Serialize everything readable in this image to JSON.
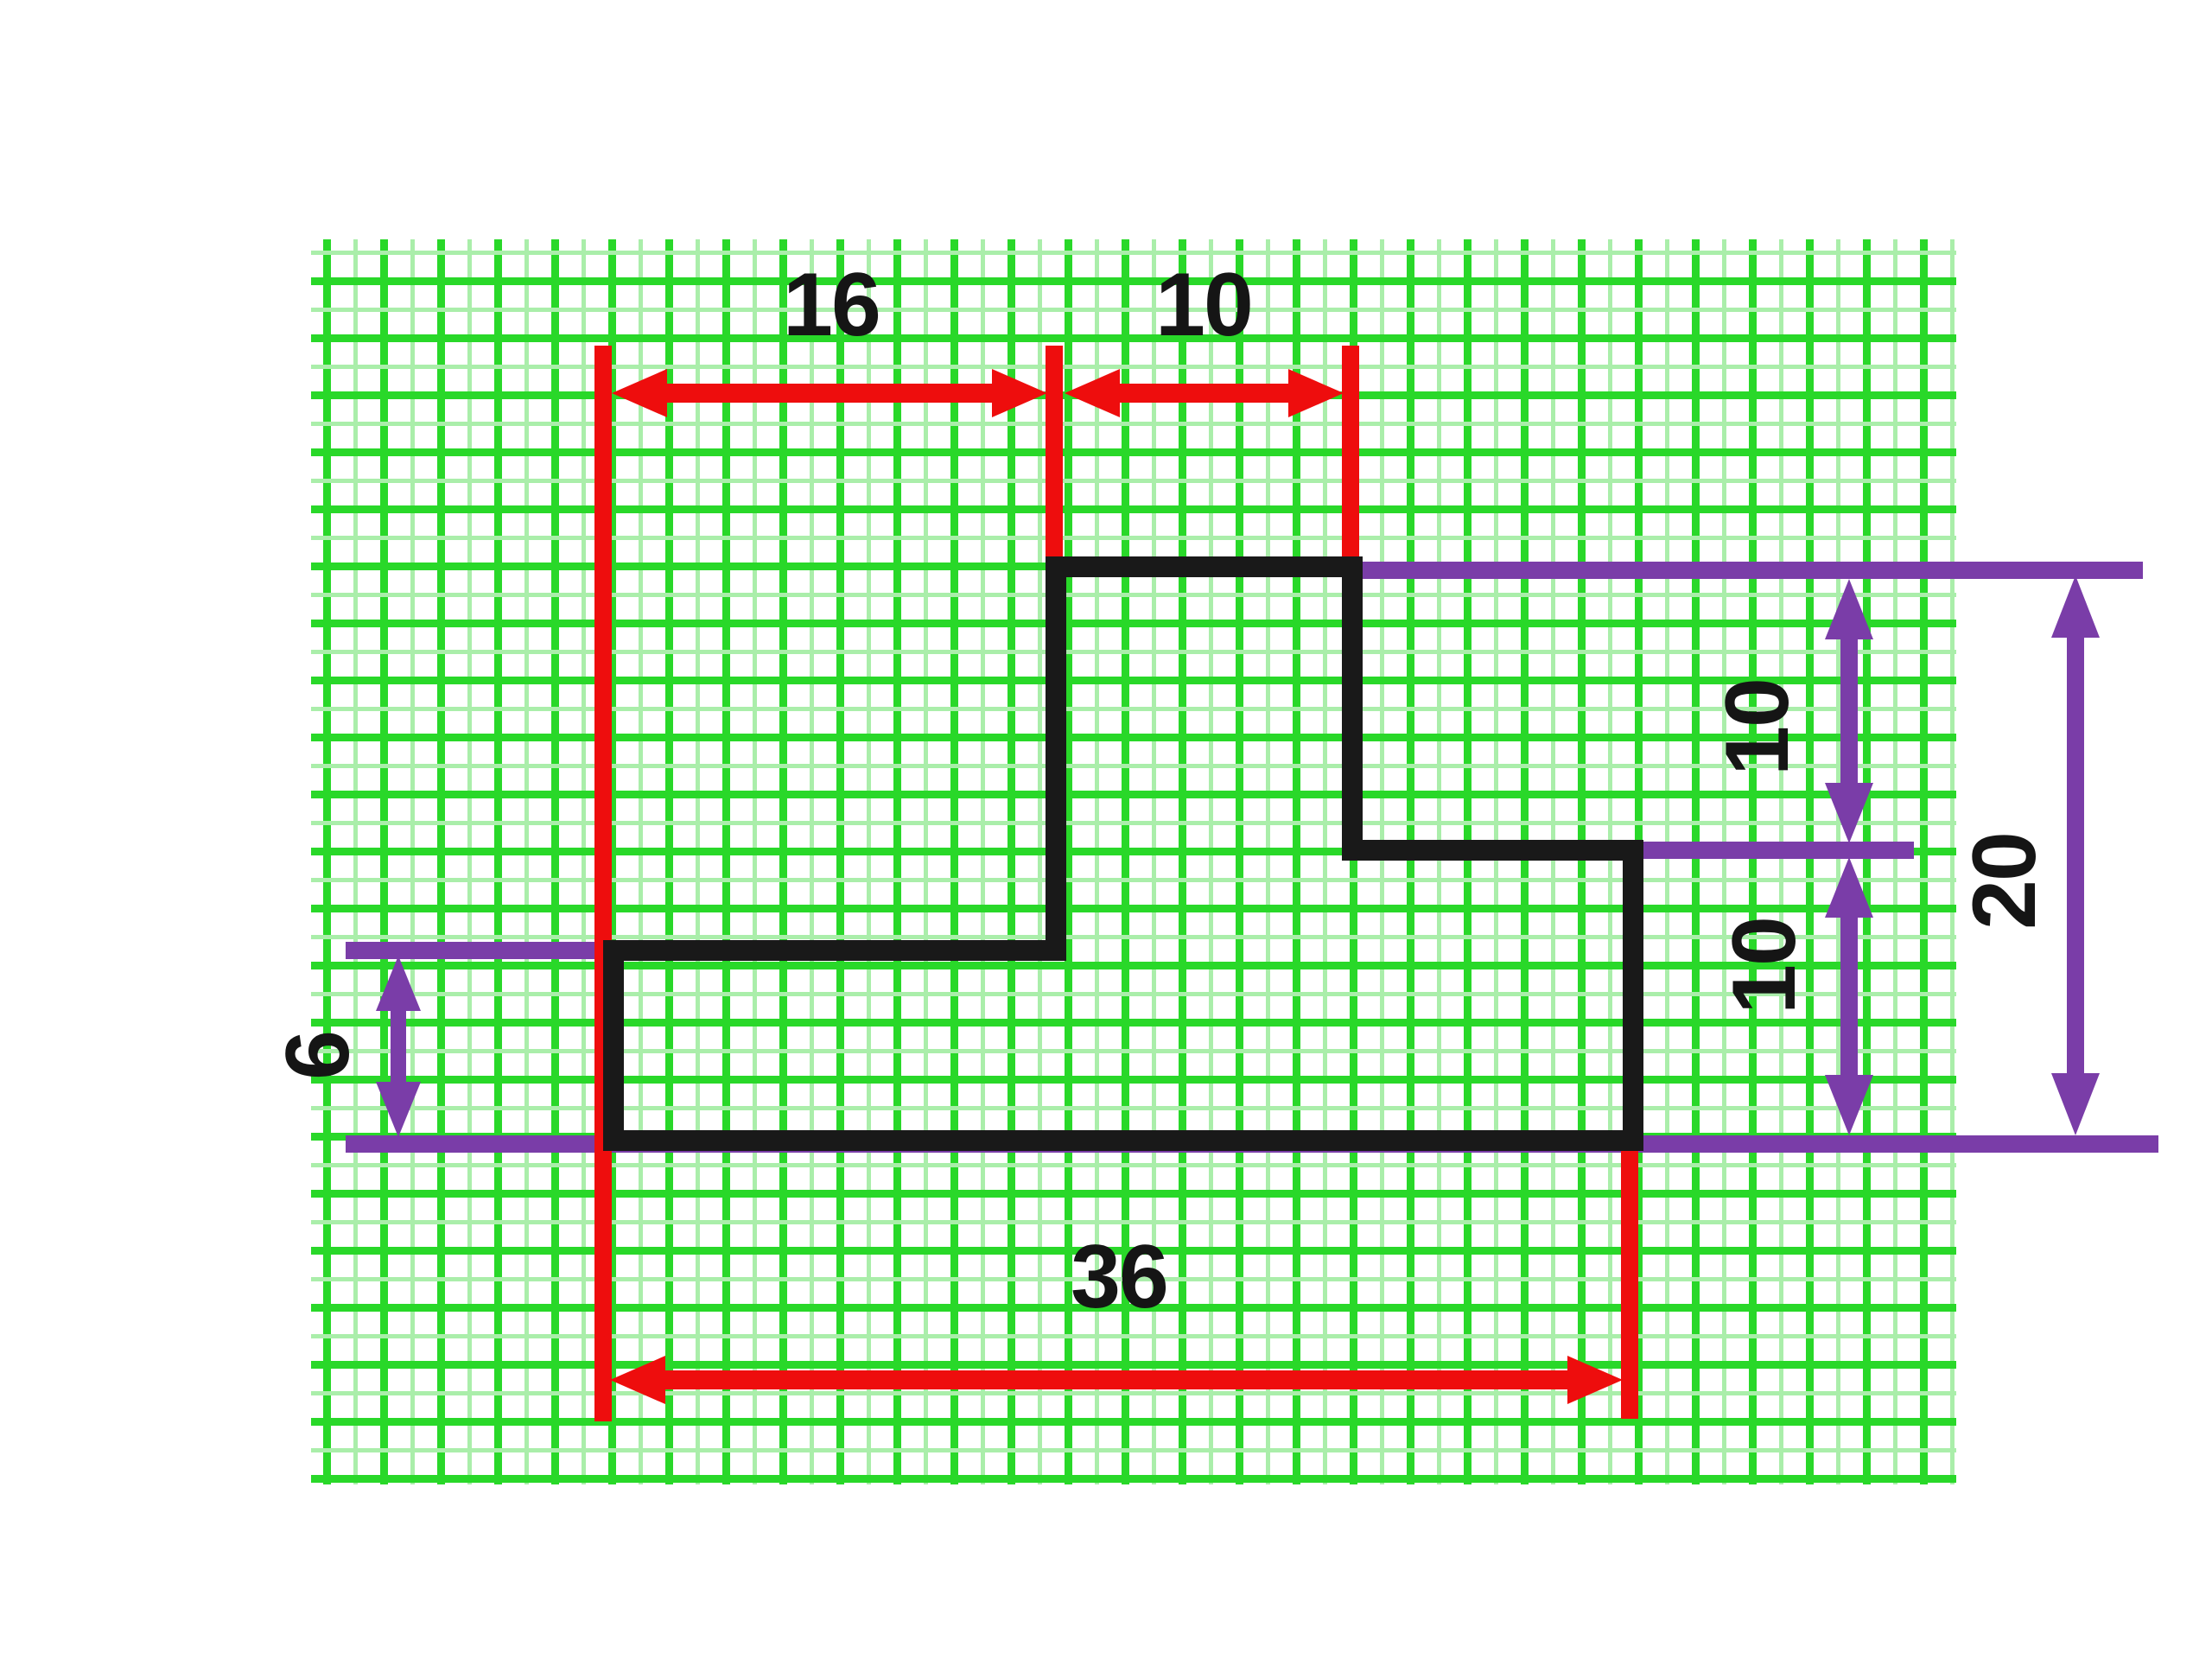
{
  "figure": {
    "type": "dimensioned-technical-drawing",
    "description": "Stepped polygon outline drawn on green graph paper with red and purple dimension arrows",
    "grid": {
      "cell_units": 2,
      "line_color": "#29d829",
      "minor_line_color": "#aaeeaa",
      "background": "#ffffff"
    },
    "shape": {
      "outline_color": "#191919",
      "vertices_units": [
        [
          16,
          0
        ],
        [
          26,
          0
        ],
        [
          26,
          10
        ],
        [
          36,
          10
        ],
        [
          36,
          20
        ],
        [
          0,
          20
        ],
        [
          0,
          14
        ],
        [
          16,
          14
        ]
      ]
    },
    "colors": {
      "red_dimension": "#ee0d0d",
      "purple_dimension": "#7a3da8",
      "label_text": "#151515"
    },
    "labels": {
      "top_left": "16",
      "top_right": "10",
      "bottom": "36",
      "left": "6",
      "right_upper": "10",
      "right_lower": "10",
      "right_total": "20"
    },
    "dimensions": {
      "top": [
        {
          "label": "16",
          "from_units": 0,
          "to_units": 16,
          "color": "red"
        },
        {
          "label": "10",
          "from_units": 16,
          "to_units": 26,
          "color": "red"
        }
      ],
      "bottom": [
        {
          "label": "36",
          "from_units": 0,
          "to_units": 36,
          "color": "red"
        }
      ],
      "right": [
        {
          "label": "10",
          "from_units": 0,
          "to_units": 10,
          "color": "purple"
        },
        {
          "label": "10",
          "from_units": 10,
          "to_units": 20,
          "color": "purple"
        },
        {
          "label": "20",
          "from_units": 0,
          "to_units": 20,
          "color": "purple"
        }
      ],
      "left": [
        {
          "label": "6",
          "from_units": 14,
          "to_units": 20,
          "color": "purple"
        }
      ]
    }
  }
}
